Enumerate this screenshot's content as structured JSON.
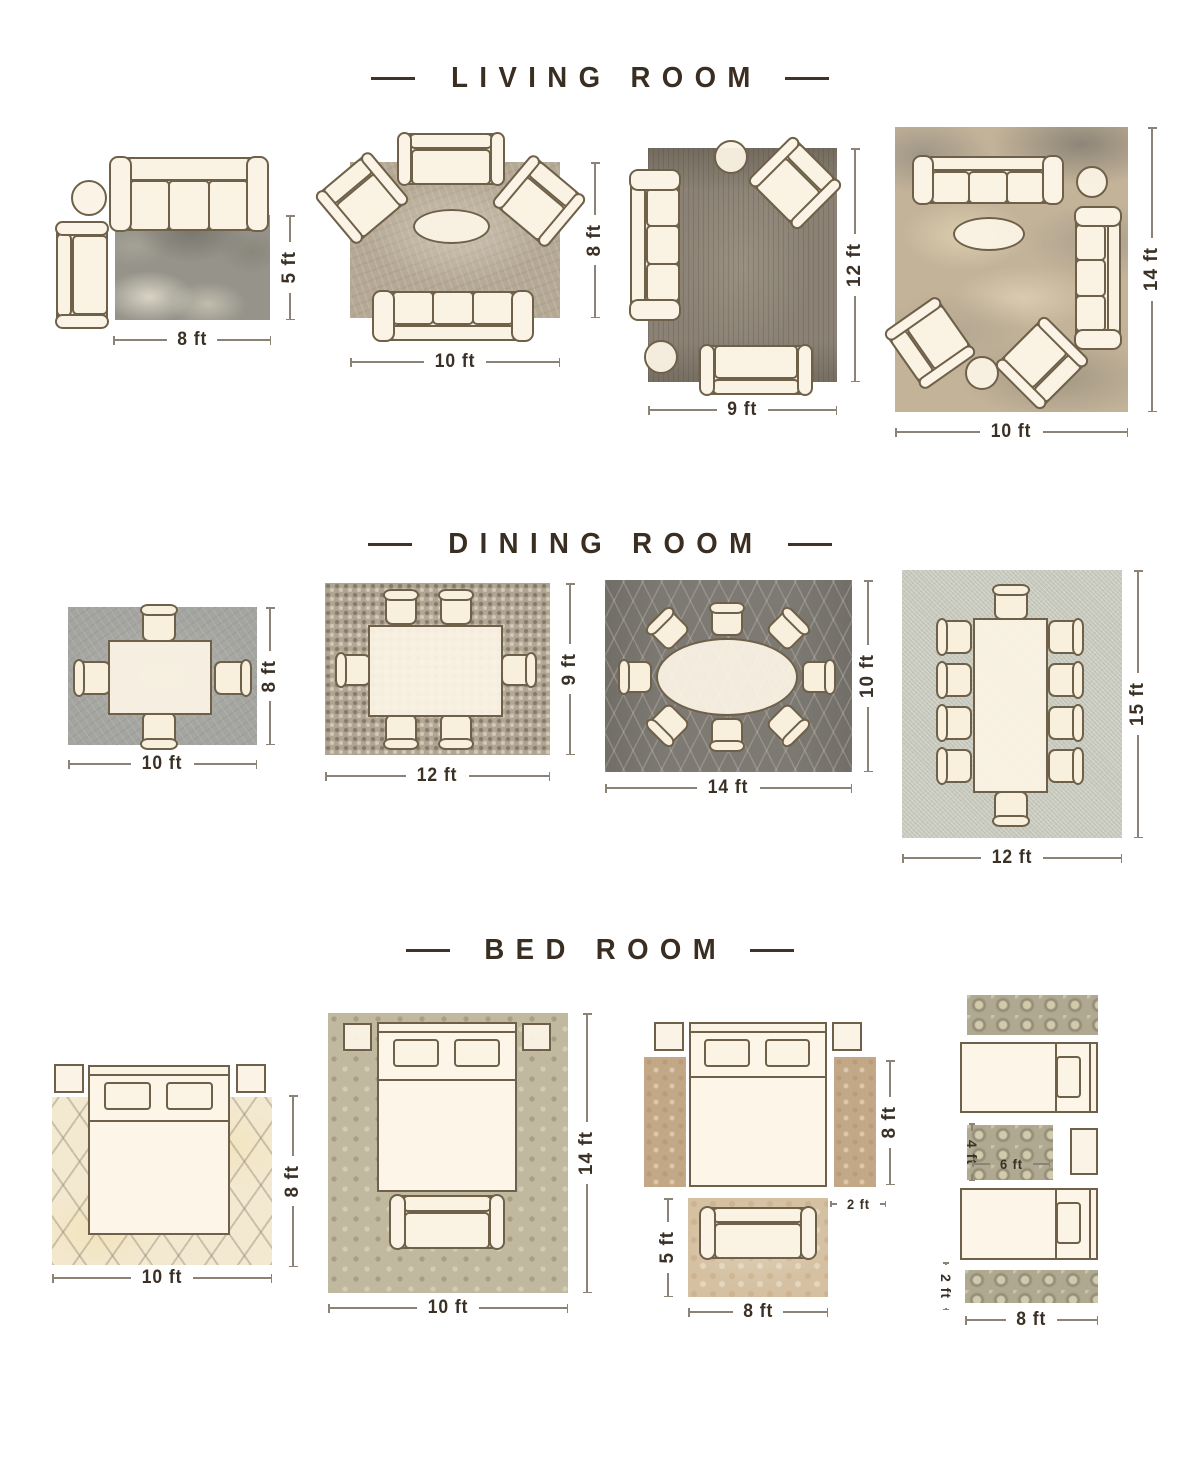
{
  "colors": {
    "title_text": "#3a2d21",
    "dimension_text": "#3a3025",
    "dimension_line": "#8c8276",
    "furniture_fill": "#faf2e2",
    "furniture_outline": "#6f6149"
  },
  "sections": [
    {
      "title": "LIVING ROOM",
      "layouts": [
        {
          "w": "8 ft",
          "h": "5 ft"
        },
        {
          "w": "10 ft",
          "h": "8 ft"
        },
        {
          "w": "9 ft",
          "h": "12 ft"
        },
        {
          "w": "10 ft",
          "h": "14 ft"
        }
      ]
    },
    {
      "title": "DINING ROOM",
      "layouts": [
        {
          "w": "10 ft",
          "h": "8 ft"
        },
        {
          "w": "12 ft",
          "h": "9 ft"
        },
        {
          "w": "14 ft",
          "h": "10 ft"
        },
        {
          "w": "12 ft",
          "h": "15 ft"
        }
      ]
    },
    {
      "title": "BED ROOM",
      "layouts": [
        {
          "w": "10 ft",
          "h": "8 ft"
        },
        {
          "w": "10 ft",
          "h": "14 ft"
        },
        {
          "runner_h": "8 ft",
          "runner_w": "2 ft",
          "accent_rug_h": "5 ft",
          "accent_rug_w": "8 ft"
        },
        {
          "small_rug_h": "4 ft",
          "small_rug_w": "6 ft",
          "runner_h": "2 ft",
          "w": "8 ft"
        }
      ]
    }
  ]
}
